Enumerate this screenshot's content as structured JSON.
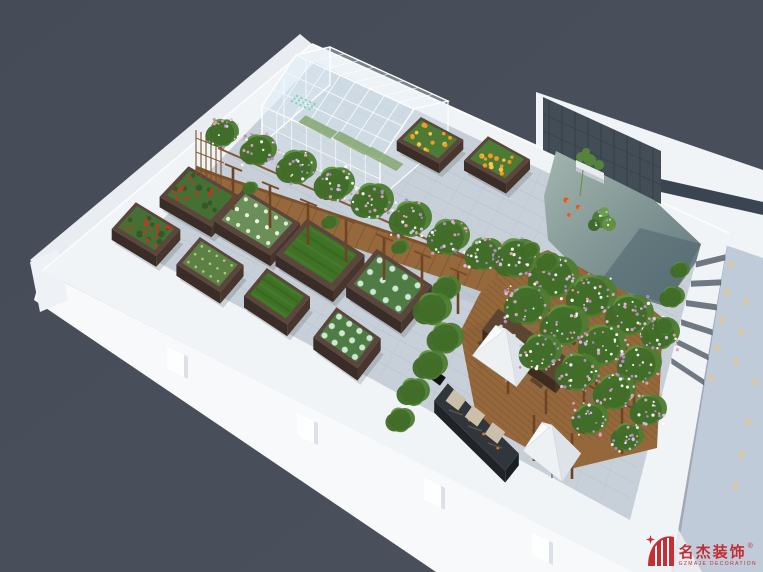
{
  "image": {
    "type": "3d-architectural-rendering",
    "subject": "Rooftop vegetable garden and leisure terrace, axonometric aerial view",
    "width_px": 763,
    "height_px": 572
  },
  "background": {
    "color": "#49505c"
  },
  "logo": {
    "brand_cn": "名杰装饰",
    "registered_mark": "®",
    "brand_en": "GZMAJE DECORATION",
    "color": "#c3242b"
  },
  "scene": {
    "elements": [
      "white parapet walls",
      "glass greenhouse",
      "vine-covered pergola",
      "wooden walkway",
      "timber deck",
      "raised planter beds",
      "koi pond",
      "slate feature wall",
      "wall-mounted planter",
      "outdoor dining table with chairs",
      "white patio canopies",
      "bbq counter",
      "folding chairs",
      "paved courtyard floor"
    ],
    "planter_beds": [
      {
        "x": 430,
        "y": 150,
        "la": 24,
        "lb": 17,
        "crop": "marigolds"
      },
      {
        "x": 497,
        "y": 170,
        "la": 24,
        "lb": 17,
        "crop": "marigolds"
      },
      {
        "x": 200,
        "y": 207,
        "la": 30,
        "lb": 21,
        "crop": "tomatoes"
      },
      {
        "x": 146,
        "y": 240,
        "la": 26,
        "lb": 18,
        "crop": "tomatoes"
      },
      {
        "x": 257,
        "y": 233,
        "la": 33,
        "lb": 22,
        "crop": "lettuce"
      },
      {
        "x": 210,
        "y": 276,
        "la": 26,
        "lb": 18,
        "crop": "seedlings"
      },
      {
        "x": 320,
        "y": 266,
        "la": 34,
        "lb": 24,
        "crop": "grass"
      },
      {
        "x": 277,
        "y": 308,
        "la": 26,
        "lb": 18,
        "crop": "grass"
      },
      {
        "x": 389,
        "y": 297,
        "la": 33,
        "lb": 24,
        "crop": "cabbage"
      },
      {
        "x": 347,
        "y": 350,
        "la": 27,
        "lb": 19,
        "crop": "cabbage"
      }
    ],
    "pond": {
      "fish": "koi",
      "fish_count": 3
    }
  },
  "palette": {
    "background": "#49505c",
    "wall_white": "#f1f4f7",
    "facade_right": "#bfcbd8",
    "floor_paving": "#c7d0d8",
    "tile_line": "#b6c0c9",
    "wood": "#96693d",
    "wood_dark": "#6e4326",
    "leaf_dark": "#3f6b28",
    "leaf_mid": "#4e7d32",
    "leaf_light": "#649а3f",
    "flower_purple": "#b48cc8",
    "water": "#8da49e",
    "slate": "#434d55",
    "navy_band": "#3a4551",
    "canopy": "#eef1f4",
    "logo_red": "#c3242b"
  }
}
